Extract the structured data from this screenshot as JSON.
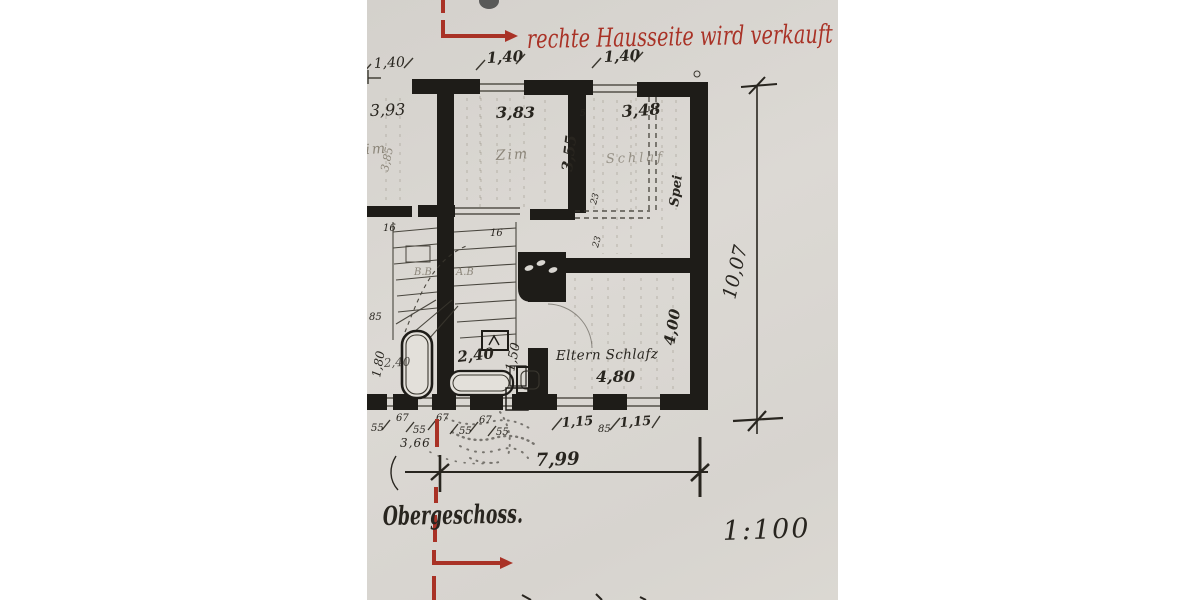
{
  "colors": {
    "red": "#a93226",
    "ink": "#28251f",
    "pencil": "#8b8579",
    "blue_ink": "#39405a",
    "paper": "#d8d5d0"
  },
  "annotations": {
    "red_note": "rechte Hausseite wird verkauft",
    "floor_title": "Obergeschoss.",
    "scale": "1:100"
  },
  "room_labels": {
    "zim_left": "Zim",
    "zim_mid": "Zim",
    "schlaf": "Schlaf",
    "spei": "Spei",
    "eltern": "Eltern Schlafz"
  },
  "dims": {
    "top_left": "1,40",
    "top_mid": "1,40",
    "top_right": "1,40",
    "w_left": "3,93",
    "w_mid": "3,83",
    "w_right": "3,48",
    "d_mid": "3,55",
    "d_left": "3,85",
    "house_depth": "10,07",
    "house_width": "7,99",
    "eltern_w": "4,80",
    "eltern_d": "4,00",
    "bath_w": "2,40",
    "bath_w2": "2,40",
    "bath_d": "1,80",
    "niche": "1,50",
    "left_seg": "3,66",
    "p55a": "55",
    "w67a": "67",
    "p55b": "55",
    "w67b": "67",
    "p55c": "55",
    "w67c": "67",
    "p55d": "55",
    "w115a": "1,15",
    "p85": "85",
    "w115b": "1,15",
    "t23a": "23",
    "t23b": "23",
    "t5": "5",
    "s16a": "16",
    "s16b": "16",
    "s85": "85",
    "sbb": "B.B",
    "sab": "A.B"
  }
}
